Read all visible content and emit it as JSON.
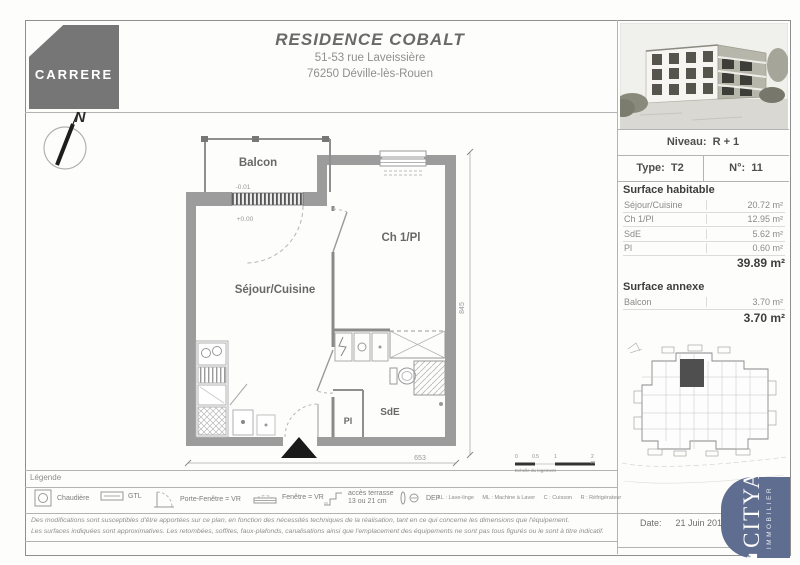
{
  "header": {
    "logo": "CARRERE",
    "title": "RESIDENCE COBALT",
    "address1": "51-53 rue Laveissière",
    "address2": "76250 Déville-lès-Rouen"
  },
  "info_panel": {
    "niveau_label": "Niveau:",
    "niveau_value": "R + 1",
    "type_label": "Type:",
    "type_value": "T2",
    "numero_label": "N°:",
    "numero_value": "11",
    "surface_habitable": {
      "title": "Surface habitable",
      "rows": [
        {
          "label": "Séjour/Cuisine",
          "value": "20.72 m²"
        },
        {
          "label": "Ch 1/Pl",
          "value": "12.95 m²"
        },
        {
          "label": "SdE",
          "value": "5.62 m²"
        },
        {
          "label": "Pl",
          "value": "0.60 m²"
        }
      ],
      "total": "39.89 m²"
    },
    "surface_annexe": {
      "title": "Surface annexe",
      "rows": [
        {
          "label": "Balcon",
          "value": "3.70 m²"
        }
      ],
      "total": "3.70 m²"
    },
    "date_label": "Date:",
    "date_value": "21 Juin 201"
  },
  "plan": {
    "north_label": "N",
    "rooms": {
      "balcon": "Balcon",
      "sejour": "Séjour/Cuisine",
      "ch1": "Ch 1/Pl",
      "sde": "SdE",
      "pl": "Pl"
    },
    "levels": {
      "balcon": "-0.01",
      "sejour": "+0.00"
    },
    "dimensions": {
      "width": "653",
      "height": "845"
    }
  },
  "legend": {
    "title": "Légende",
    "items": [
      {
        "label": "Chaudière"
      },
      {
        "label": "GTL"
      },
      {
        "label": "Porte-Fenêtre = VR"
      },
      {
        "label": "Fenêtre = VR"
      },
      {
        "label": "accès terrasse",
        "label2": "13 ou 21 cm"
      },
      {
        "label": "DEP"
      }
    ],
    "abbreviations": [
      "LL : Lave-linge",
      "ML : Machine à Laver",
      "C : Cuisson",
      "R : Réfrigérateur"
    ],
    "scale": {
      "ticks": [
        "0",
        "0.5",
        "1",
        "2 m"
      ],
      "caption": "Echelle du logement"
    }
  },
  "disclaimer": {
    "line1": "Des modifications sont susceptibles d'être apportées sur ce plan, en fonction des nécessités techniques de la réalisation, tant en ce qui concerne les dimensions que l'équipement.",
    "line2": "Les surfaces indiquées sont approximatives. Les retombées, soffites, faux-plafonds, canalisations ainsi que l'emplacement des équipements ne sont pas tous figurés ou le sont à titre indicatif."
  },
  "citya": {
    "brand": "CITYA",
    "sub": "IMMOBILIER"
  }
}
